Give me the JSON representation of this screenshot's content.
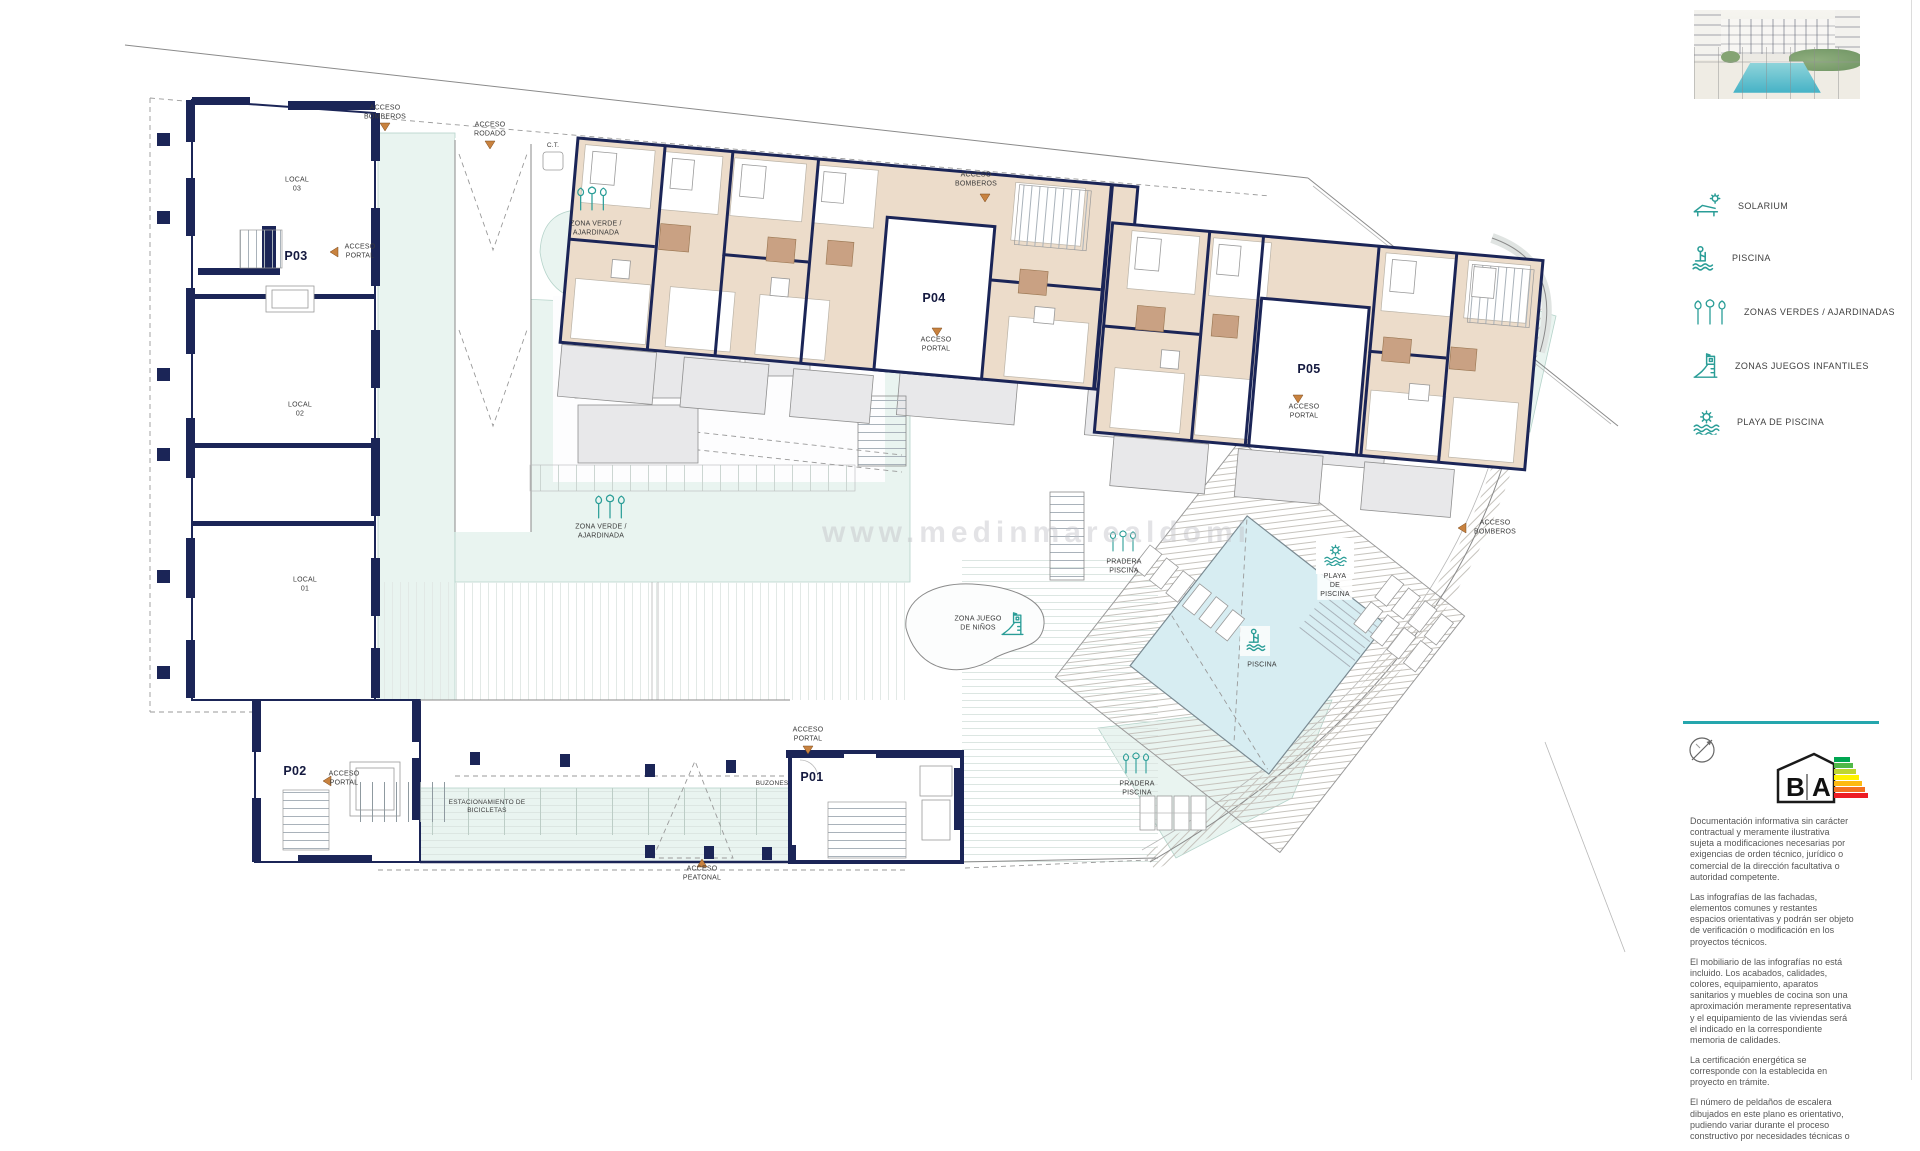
{
  "legend": {
    "items": [
      {
        "icon": "solarium-icon",
        "label": "SOLARIUM"
      },
      {
        "icon": "pool-icon",
        "label": "PISCINA"
      },
      {
        "icon": "green-zones-icon",
        "label": "ZONAS VERDES / AJARDINADAS"
      },
      {
        "icon": "playground-icon",
        "label": "ZONAS JUEGOS INFANTILES"
      },
      {
        "icon": "pool-beach-icon",
        "label": "PLAYA DE PISCINA"
      }
    ]
  },
  "plan": {
    "watermark": "www.medinmarealdomi",
    "portals": {
      "p01": "P01",
      "p02": "P02",
      "p03": "P03",
      "p04": "P04",
      "p05": "P05"
    },
    "units": {
      "local01": "LOCAL\n01",
      "local02": "LOCAL\n02",
      "local03": "LOCAL\n03",
      "ct": "C.T."
    },
    "labels": {
      "acceso_bomberos": "ACCESO\nBOMBEROS",
      "acceso_rodado": "ACCESO\nRODADO",
      "acceso_portal": "ACCESO\nPORTAL",
      "acceso_peatonal": "ACCESO\nPEATONAL",
      "zona_verde": "ZONA VERDE /\nAJARDINADA",
      "zona_juego_ninos": "ZONA JUEGO\nDE NIÑOS",
      "piscina": "PISCINA",
      "playa_de_piscina": "PLAYA\nDE\nPISCINA",
      "pradera_piscina": "PRADERA\nPISCINA",
      "estacionamiento_bicicletas": "ESTACIONAMIENTO DE\nBICICLETAS",
      "buzones": "BUZONES"
    }
  },
  "energy_rating": {
    "letter_b": "B",
    "letter_a": "A"
  },
  "disclaimer": {
    "paragraphs": [
      "Documentación informativa sin carácter contractual y meramente ilustrativa sujeta a modificaciones necesarias por exigencias de orden técnico, jurídico o comercial de la dirección facultativa o autoridad competente.",
      "Las infografías de las fachadas, elementos comunes y restantes espacios orientativas y podrán ser objeto de verificación o modificación en los proyectos técnicos.",
      "El mobiliario de las infografías no está incluido. Los acabados, calidades, colores, equipamiento, aparatos sanitarios y muebles de cocina son una aproximación meramente representativa y el equipamiento de las viviendas será el indicado en la correspondiente memoria de calidades.",
      "La certificación energética se corresponde con la establecida en proyecto en trámite.",
      "El número de peldaños de escalera dibujados en este plano es orientativo, pudiendo variar durante el proceso constructivo por necesidades técnicas o"
    ]
  },
  "colors": {
    "accent_teal": "#2a9d97",
    "wall_navy": "#1b2557",
    "arrow_orange": "#c8823f"
  }
}
